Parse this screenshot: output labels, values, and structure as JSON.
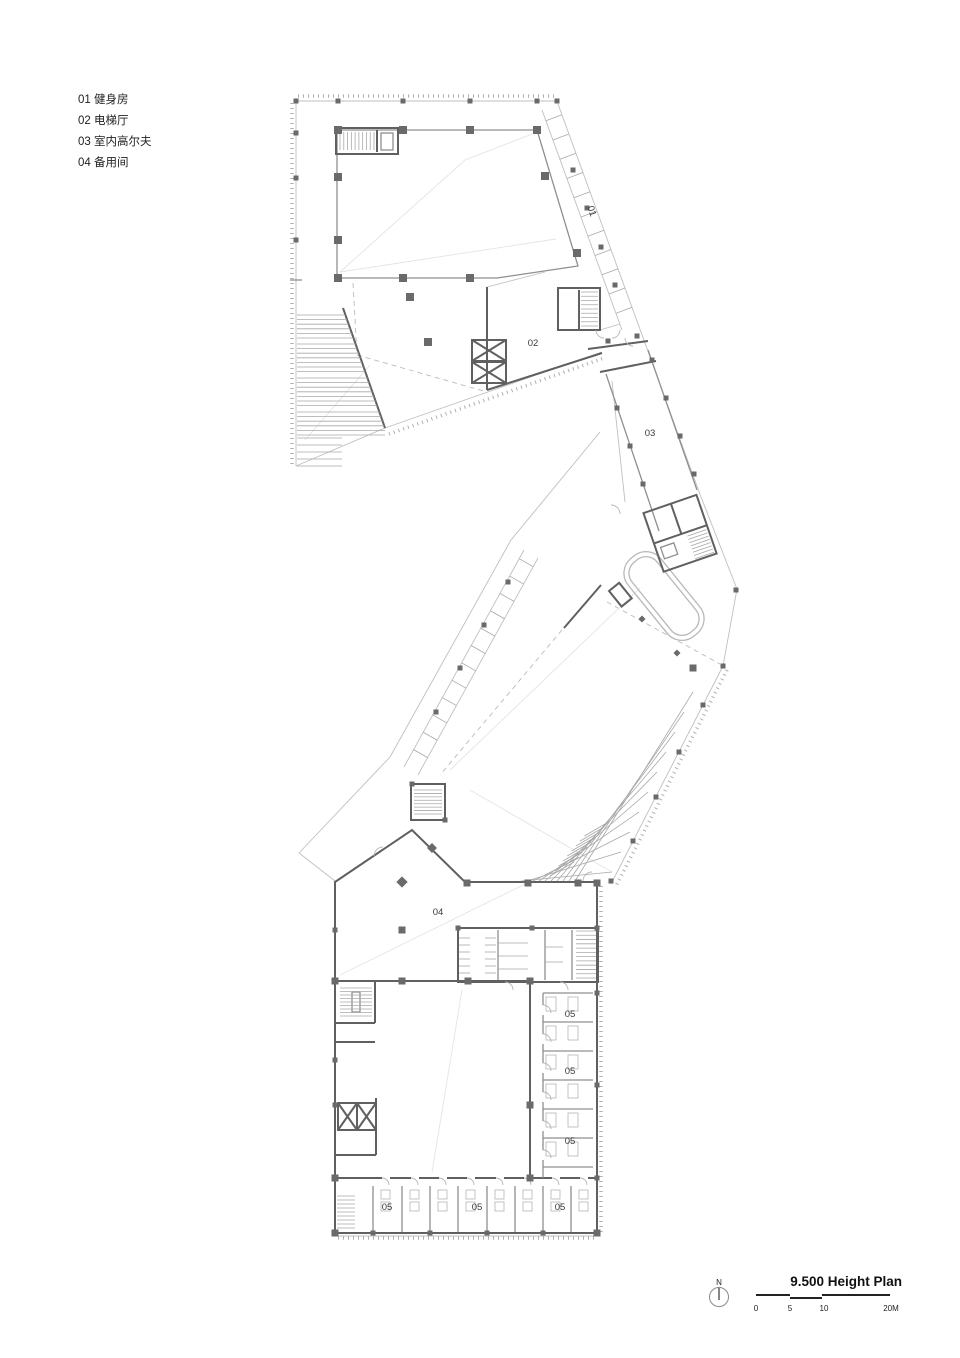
{
  "legend": {
    "items": [
      "01 健身房",
      "02 电梯厅",
      "03 室内高尔夫",
      "04 备用间"
    ]
  },
  "plan": {
    "labels": [
      {
        "text": "01"
      },
      {
        "text": "02"
      },
      {
        "text": "03"
      },
      {
        "text": "04"
      },
      {
        "text": "05"
      },
      {
        "text": "05"
      },
      {
        "text": "05"
      },
      {
        "text": "05"
      },
      {
        "text": "05"
      },
      {
        "text": "05"
      }
    ]
  },
  "title_block": {
    "north_label": "N",
    "title": "9.500 Height Plan",
    "scale_ticks": [
      "0",
      "5",
      "10",
      "20M"
    ]
  },
  "colors": {
    "wall": "#606060",
    "line": "#bfbfbf",
    "accent_text": "#111111"
  }
}
